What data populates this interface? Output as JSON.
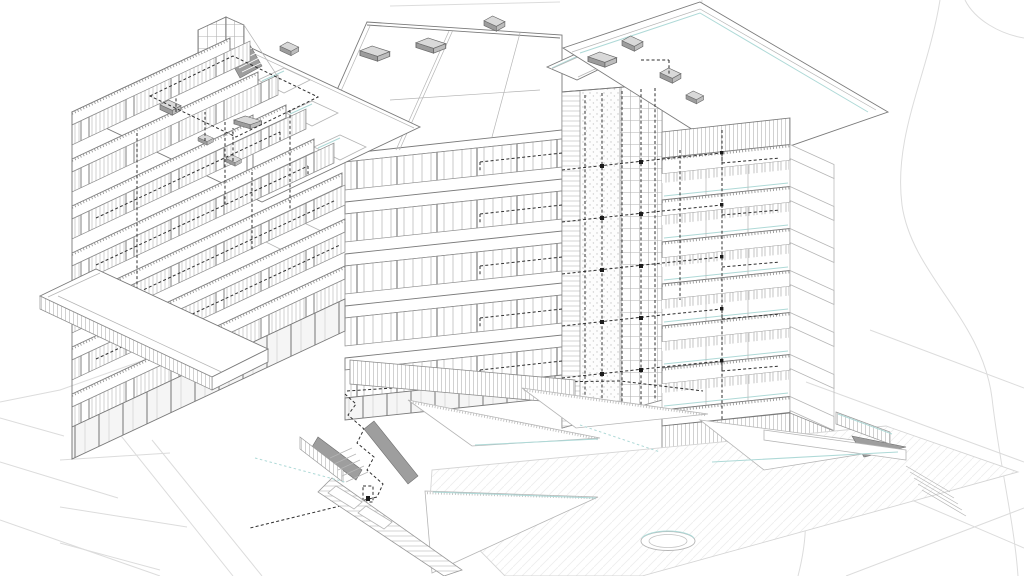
{
  "document": {
    "kind": "architectural axonometric line drawing",
    "subject": "Multi-storey residential building with service-core MEP riser overlay and terraced landscape plaza",
    "view": "aerial axonometric",
    "visible_text": "none"
  },
  "colors": {
    "paper": "#ffffff",
    "ink": "#2f2f2f",
    "line_strong": "#4a4a4a",
    "line_med": "#7a7a7a",
    "line_light": "#b5b5b5",
    "line_faint": "#dcdcdc",
    "accent_cyan": "#aed9d7",
    "gray_fill": "#9e9e9e",
    "gray_mid": "#c9c9c9",
    "gray_soft": "#efefef"
  },
  "building": {
    "left_wing": {
      "floors": 7,
      "features": [
        "stacked balcony fascias",
        "ribbon windows with mullions",
        "flat roof with parapet",
        "stair bulkhead tower"
      ]
    },
    "central_block": {
      "floors": 6,
      "features": [
        "sloped roof planes",
        "rooftop courtyards",
        "ground-floor colonnade"
      ]
    },
    "service_core": {
      "features": [
        "stippled shaft",
        "gridded facade strip",
        "dashed MEP risers",
        "floor branch connections"
      ]
    },
    "right_block": {
      "floors": 7,
      "features": [
        "open corner balconies",
        "flat roof with vents",
        "stepped side slabs"
      ]
    },
    "rooftop_units": 11
  },
  "site": {
    "elements": [
      "terrain contour lines",
      "angular terraced plaza walls",
      "ramp with shaded cheek walls",
      "stepped walkway with planters",
      "circular fountain ring",
      "balustrade fences"
    ]
  },
  "mep_overlay": {
    "style": "black dashed lines",
    "vertical_risers": 5,
    "floor_branch_levels": 6,
    "ground_route": "zig-zag drop to plaza walkway"
  }
}
